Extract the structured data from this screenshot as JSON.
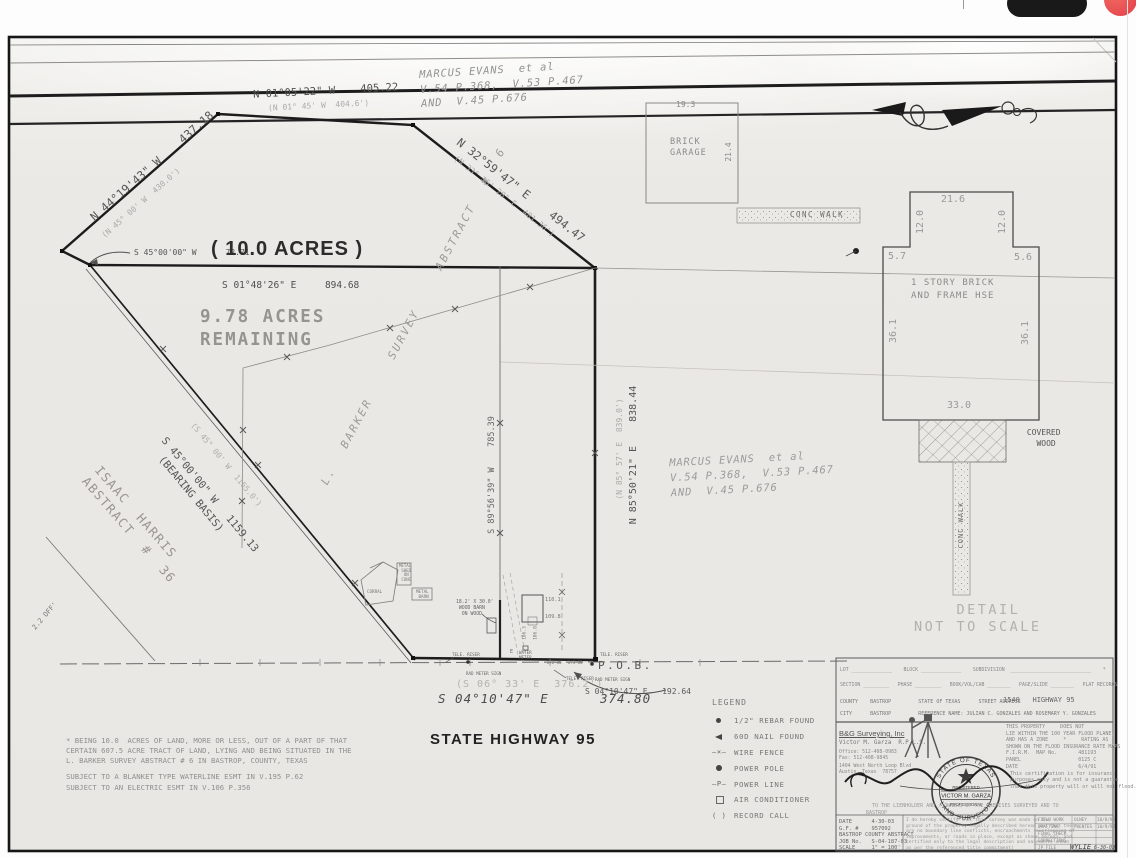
{
  "plat": {
    "owners_top": "MARCUS EVANS  et al\nV.54 P.368,  V.53 P.467\nAND  V.45 P.676",
    "owners_mid": "MARCUS EVANS  et al\nV.54 P.368,  V.53 P.467\nAND  V.45 P.676",
    "acres_tract": "( 10.0 ACRES )",
    "acres_remaining": "9.78 ACRES\nREMAINING",
    "abstract_barker": "L. BARKER  SURVEY  ABSTRACT # 6",
    "abstract_harris": "ISAAC  HARRIS\nABSTRACT  #  36",
    "pob": "P.O.B.",
    "highway": "STATE HIGHWAY 95",
    "bearing_top": "N 01°05'22\" W    405.22",
    "bearing_top_record": "(N 01° 45' W  404.6')",
    "bearing_nw": "N 44°19'43\" W    437.18",
    "bearing_nw_record": "(N 45° 00' W  430.0')",
    "bearing_ne": "N 32°59'47\" E    494.47",
    "bearing_ne_record": "(N 33° 35' 28\" E  481.36')",
    "bearing_sw": "S 45°00'00\" W   1159.13\n  (BEARING BASIS)",
    "bearing_sw_record": "(S 45° 00' W  1165.0')",
    "bearing_sw_short": "S 45°00'00\" W      72.71",
    "bearing_east": "N 85°50'21\" E    838.44",
    "bearing_east_record": "(N 85° 57' E  839.0')",
    "bearing_interior": "S 89°56'39\" W    785.39",
    "bearing_north_interior": "S 01°48'26\" E     894.68",
    "bearing_south": "S 04°10'47\" E      374.80",
    "bearing_south_record": "(S 06° 33' E  376.2')",
    "bearing_south2": "S 04°10'47\" E   192.64",
    "off_note": "2.2 OFF'",
    "notes": "* BEING 10.0  ACRES OF LAND, MORE OR LESS, OUT OF A PART OF THAT\nCERTAIN 607.5 ACRE TRACT OF LAND, LYING AND BEING SITUATED IN THE\nL. BARKER SURVEY ABSTRACT # 6 IN BASTROP, COUNTY, TEXAS",
    "subject_notes": "SUBJECT TO A BLANKET TYPE WATERLINE ESMT IN V.195 P.62\nSUBJECT TO AN ELECTRIC ESMT IN V.106 P.356",
    "features": {
      "corral": "CORRAL",
      "metal_shed": "METAL\n SHED\n  ON\n CONC",
      "metal_barn": "METAL\n BARN",
      "wood_barn": "18.2' X 30.0'\n WOOD BARN\n  ON WOOD",
      "well_dim1": "110.1",
      "well_dim2": "109.8",
      "well_dim3": "106.3",
      "well_dim4": "106.8",
      "water_meter": "WATER\nMETER",
      "tele_riser": "TELE. RISER",
      "rad_meter": "RAD METER SIGN",
      "on1": "2.2 ON",
      "on2": "2.3 ON",
      "e_mark": "E"
    }
  },
  "detail": {
    "garage": "BRICK\nGARAGE",
    "garage_w": "19.3",
    "garage_d": "21.4",
    "walk": "CONC WALK",
    "walk_v": "CONC WALK",
    "house": "1 STORY BRICK\nAND FRAME HSE",
    "dims": {
      "top": "21.6",
      "left_upper": "12.0",
      "right_upper": "12.0",
      "left_jog": "5.7",
      "right_jog": "5.6",
      "left": "36.1",
      "right": "36.1",
      "bottom": "33.0"
    },
    "covered": " COVERED\n   WOOD",
    "title": "    DETAIL\nNOT TO SCALE"
  },
  "legend": {
    "title": "LEGEND",
    "sym_fence": "—✕—",
    "sym_pline": "–P–",
    "sym_record": "(  )",
    "items": [
      {
        "label": "1/2\" REBAR FOUND"
      },
      {
        "label": "60D NAIL FOUND"
      },
      {
        "label": "WIRE FENCE"
      },
      {
        "label": "POWER POLE"
      },
      {
        "label": "POWER LINE"
      },
      {
        "label": "AIR CONDITIONER"
      },
      {
        "label": "RECORD CALL"
      }
    ]
  },
  "titleblock": {
    "row1": "LOT ______________    BLOCK ______________    SUBDIVISION  ____________________________    *",
    "row2": "SECTION _________   PHASE _________   BOOK/VOL/CAB ________   PAGE/SLIDE ________   PLAT RECORDS",
    "row3": "COUNTY    BASTROP         STATE OF TEXAS      STREET ADDRESS",
    "row3_addr": "1540   HIGHWAY 95",
    "row4": "CITY      BASTROP         REFERENCE NAME: JULIAN C. GONZALES AND ROSEMARY Y. GONZALES",
    "firm": "B&G Surveying, Inc",
    "surveyor": "Victor M. Garza  R.P.L.S.",
    "firm_contact": "Office: 512-408-0983\nFax: 512-408-9845",
    "firm_address": "1404 West North Loop Blvd\nAustin, Texas  78757",
    "flood": "THIS PROPERTY     DOES NOT\nLIE WITHIN THE 100 YEAR FLOOD PLANE,\nAND HAS A ZONE     *     RATING AS\nSHOWN ON THE FLOOD INSURANCE RATE MAPS\nF.I.R.M.  MAP No.       481193\nPANEL                   0125 C\nDATE                    6/4/91",
    "flood_note": "This certification is for insurance\npurposes only and is not a guarantee\nthat this property will or will not flood.",
    "cert_to": "TO THE LIENHOLDER AND / OWNERS OF THE PREMISES SURVEYED AND TO",
    "cert_to2": "BASTROP",
    "info": "DATE      4-30-03\nG.F. #    957092\nBASTROP COUNTY ABSTRACT\nJOB No.   S-04-187-03\nSCALE     1\" = 100'",
    "certification": "I do hereby certify that this survey was made on the\nground of the property legally described hereon and that there\nare no boundary line conflicts, encroachments (overlapping of\nimprovements, or roads in place, except as shown hereon, and\ncertified only to the legal description and easements shown\nas per the referenced title commitment)",
    "table": {
      "rows": [
        [
          "FIELD WORK",
          "OLNEY",
          "10/8/98"
        ],
        [
          "DRAFTING",
          "FUENTES",
          "10/9/98"
        ],
        [
          "FINAL CHECK",
          "",
          ""
        ],
        [
          "CORRECTIONS",
          "",
          ""
        ],
        [
          "JP FILE",
          "WYLIE",
          "6-30-03"
        ]
      ]
    },
    "seal": {
      "top": "STATE OF TEXAS",
      "registered": "REGISTERED",
      "name": "VICTOR M. GARZA",
      "professional": "PROFESSIONAL",
      "bottom": "LAND SURVEYOR"
    }
  }
}
